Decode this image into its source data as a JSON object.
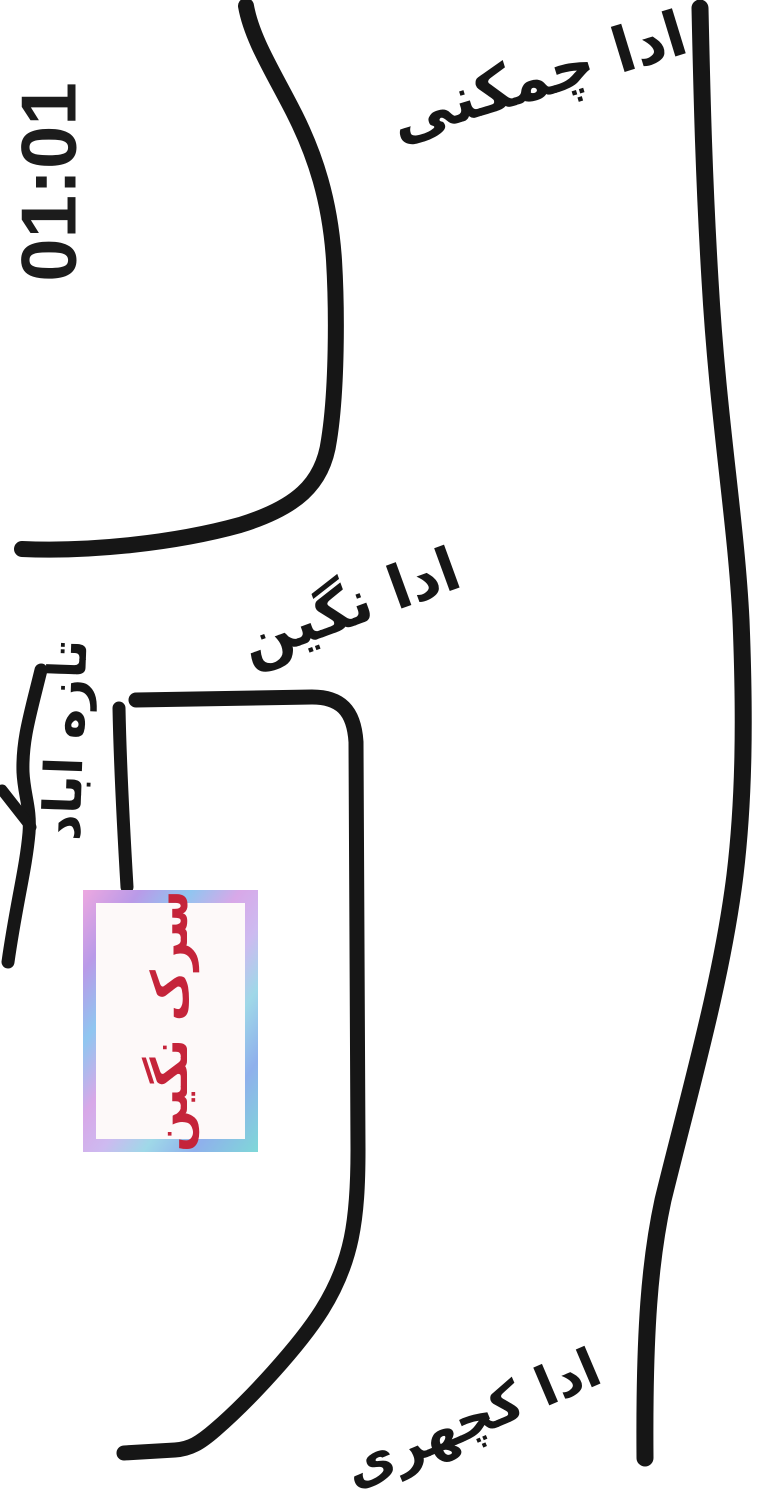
{
  "timestamp": "01:01",
  "labels": {
    "top_adda": "ادا چمکنی",
    "middle_adda": "ادا نگین",
    "taza_abad": "تازه اباد",
    "bottom_adda": "ادا کچهری",
    "box_location": "سرک نگین"
  },
  "colors": {
    "ink": "#161616",
    "timestamp_text": "#1c1c1c",
    "box_text_red": "#c5243a",
    "box_border_palette": [
      "#eda8e0",
      "#b99ae8",
      "#8fc6f0",
      "#d8a8e8",
      "#9fd8e8",
      "#7fd8d8"
    ],
    "background": "#ffffff"
  },
  "map": {
    "type": "hand-drawn street sketch",
    "roads": {
      "top_curve_road": "M 246 6 C 252 40 275 75 295 115 C 315 155 330 200 334 260 C 337 310 337 390 329 440 C 323 485 295 508 240 525 C 175 543 90 552 22 549",
      "right_main_road": "M 700 8 C 702 100 704 180 710 280 C 718 420 736 520 741 620 C 745 720 744 800 735 875 C 722 980 690 1090 663 1200 C 650 1260 644 1330 645 1458",
      "middle_l_road": "M 136 700 L 312 697 C 340 697 354 710 356 742 L 358 1150 C 358 1220 352 1262 322 1310 C 300 1345 250 1400 215 1430 C 200 1443 190 1449 175 1450 L 124 1453",
      "box_access_lane": "M 119 708 C 120 760 123 820 127 887",
      "left_side_road": "M 41 670 C 30 715 22 740 23 772 C 24 795 31 808 29 833 C 26 868 16 905 8 962",
      "left_side_road_branch": "M 2 790 L 31 827"
    }
  }
}
